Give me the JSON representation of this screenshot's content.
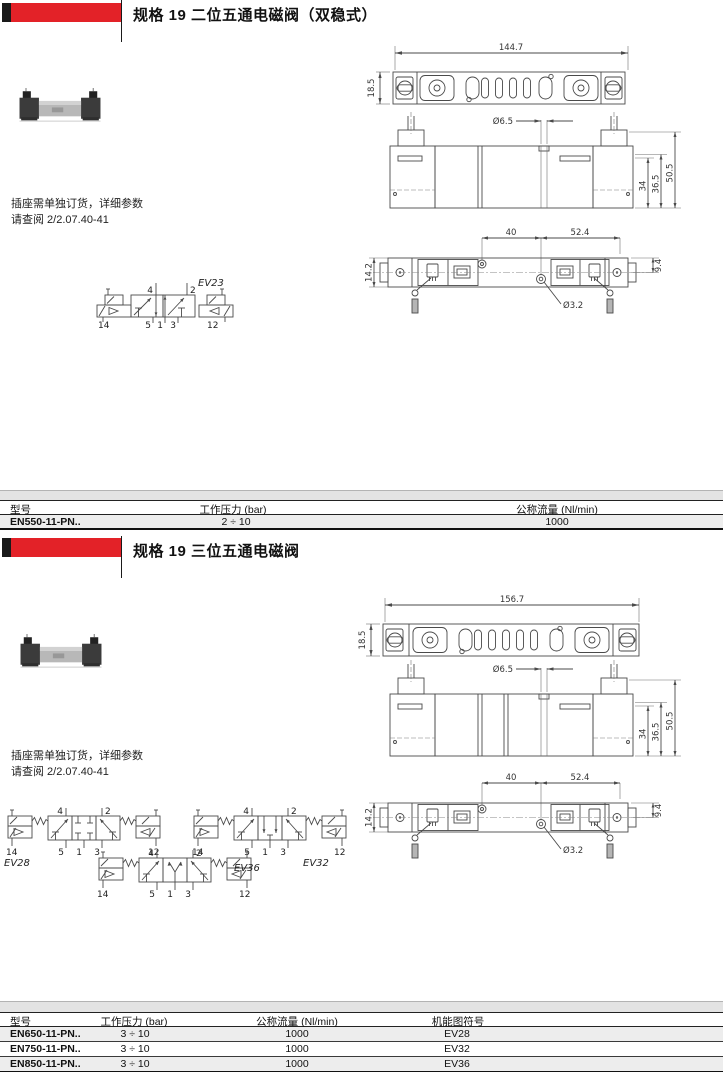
{
  "colors": {
    "accent_red": "#e32228",
    "table_band_gray": "#e3e3e3"
  },
  "sections": [
    {
      "title": "规格 19 二位五通电磁阀（双稳式）",
      "note_lines": [
        "插座需单独订货，详细参数",
        "请查阅 2/2.07.40-41"
      ],
      "dims": {
        "total_width": "144.7",
        "total_depth": "18.5",
        "hole_top": "Ø6.5",
        "height_inner": "34",
        "height_mid": "36.5",
        "height_total": "50.5",
        "pitch_left": "40",
        "pitch_right": "52.4",
        "side_left": "14.2",
        "side_right": "9.4",
        "hole_bottom": "Ø3.2"
      },
      "symbols": [
        {
          "label": "EV23",
          "ports_top": [
            "4",
            "2"
          ],
          "ports_bottom": [
            "14",
            "5",
            "1",
            "3",
            "12"
          ]
        }
      ],
      "table": {
        "headers": [
          "型号",
          "工作压力 (bar)",
          "公称流量 (Nl/min)"
        ],
        "rows": [
          [
            "EN550-11-PN..",
            "2 ÷ 10",
            "1000"
          ]
        ]
      }
    },
    {
      "title": "规格 19 三位五通电磁阀",
      "note_lines": [
        "插座需单独订货，详细参数",
        "请查阅 2/2.07.40-41"
      ],
      "dims": {
        "total_width": "156.7",
        "total_depth": "18.5",
        "hole_top": "Ø6.5",
        "height_inner": "34",
        "height_mid": "36.5",
        "height_total": "50.5",
        "pitch_left": "40",
        "pitch_right": "52.4",
        "side_left": "14.2",
        "side_right": "9.4",
        "hole_bottom": "Ø3.2"
      },
      "symbols": [
        {
          "label": "EV28",
          "ports_top": [
            "4",
            "2"
          ],
          "ports_bottom": [
            "14",
            "5",
            "1",
            "3",
            "12"
          ]
        },
        {
          "label": "EV32",
          "ports_top": [
            "4",
            "2"
          ],
          "ports_bottom": [
            "14",
            "5",
            "1",
            "3",
            "12"
          ]
        },
        {
          "label": "EV36",
          "ports_top": [
            "4",
            "2"
          ],
          "ports_bottom": [
            "14",
            "5",
            "1",
            "3",
            "12"
          ]
        }
      ],
      "table": {
        "headers": [
          "型号",
          "工作压力 (bar)",
          "公称流量 (Nl/min)",
          "机能图符号"
        ],
        "rows": [
          [
            "EN650-11-PN..",
            "3 ÷ 10",
            "1000",
            "EV28"
          ],
          [
            "EN750-11-PN..",
            "3 ÷ 10",
            "1000",
            "EV32"
          ],
          [
            "EN850-11-PN..",
            "3 ÷ 10",
            "1000",
            "EV36"
          ]
        ]
      }
    }
  ]
}
